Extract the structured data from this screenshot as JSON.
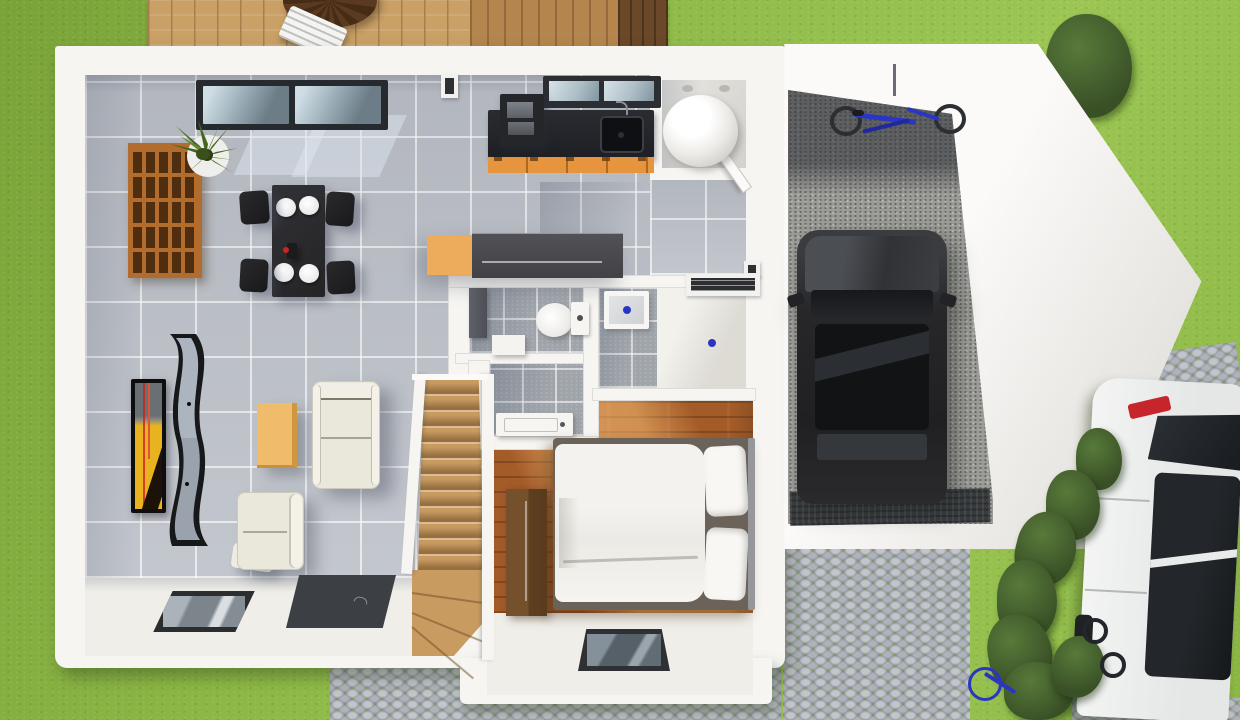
{
  "scene": {
    "title": "3D top-down floor plan rendering of a single-storey house with attached garage",
    "view": "top-down architectural visualization",
    "visible_text": ""
  },
  "palette": {
    "grass-a": "#8cb845",
    "grass-b": "#9cc654",
    "grass-c": "#7aa338",
    "deck-a": "#c9a066",
    "deck-line": "#a87f4c",
    "deck-dark": "#6b4827",
    "wall": "#f6f5f2",
    "tile": "#bcc0c8",
    "bath-tile": "#a0a5ab",
    "white-floor": "#efeee9",
    "wood": "#a35b28",
    "stair": "#c89b61",
    "counter": "#1f2126",
    "cabinet": "#e6953e",
    "island-orange": "#edac5c",
    "sofa": "#eae7db",
    "coffee": "#f0bc6b",
    "coffee-side": "#d1973f",
    "rug": "#3c3f43",
    "tv-yellow": "#e9b320",
    "tv-red": "#cc2121",
    "garage-b": "#9c9c97",
    "mat": "#393c3f",
    "cobble-stone": "#c2c5cb",
    "cobble-gap": "#7f9a48",
    "hedge-a": "#577a3a",
    "hedge-b": "#394f26",
    "bike": "#2a35c4",
    "car-red": "#c6252b"
  },
  "exterior": {
    "lawn": {
      "label": "lawn"
    },
    "deck": {
      "label": "wooden terrace",
      "objects": [
        "dark round slatted table",
        "white slatted chair"
      ]
    },
    "driveway": {
      "label": "cobblestone driveway with grass joints"
    },
    "hedge": {
      "label": "hedge row between driveway and street parking"
    },
    "shrub": {
      "label": "shrub at garage corner"
    },
    "white_car": {
      "label": "white car parked at right edge",
      "details": [
        "red tail light",
        "dark glass roof",
        "black wheels"
      ]
    },
    "bicycles": [
      {
        "label": "blue bicycle hung on garage wall"
      },
      {
        "label": "bicycle leaning at hedge"
      },
      {
        "label": "blue bicycle at lawn edge"
      }
    ]
  },
  "rooms": [
    {
      "id": "living-room",
      "label": "open living / dining room",
      "floor": "grey ceramic tile",
      "objects": [
        "sliding glass door",
        "cube storage shelf",
        "potted plant",
        "black dining table",
        "four black chairs",
        "four white plates",
        "wall TV with yellow artwork",
        "wave-shaped media console",
        "orange coffee table",
        "cream two-seat sofa",
        "cream armchair",
        "ottoman",
        "dark grey rug",
        "glass floor panel"
      ]
    },
    {
      "id": "kitchen",
      "label": "open kitchen",
      "objects": [
        "black worktop",
        "inset sink with faucet",
        "orange cabinet fronts",
        "tall appliance column",
        "window above sink",
        "island with orange sideboard"
      ]
    },
    {
      "id": "utility-room",
      "label": "technical room",
      "objects": [
        "water-heater cylinder",
        "ceiling spotlights"
      ]
    },
    {
      "id": "entry-hall",
      "label": "entrance hall",
      "objects": [
        "open door leaf",
        "wall radiator",
        "blue floor marker"
      ]
    },
    {
      "id": "wc",
      "label": "toilet room",
      "objects": [
        "toilet with cistern",
        "wall cupboard",
        "waste bin"
      ]
    },
    {
      "id": "washroom",
      "label": "shower room",
      "objects": [
        "washbasin counter",
        "shower tray with blue drain"
      ]
    },
    {
      "id": "bedroom",
      "label": "bedroom",
      "floor": "wood parquet",
      "objects": [
        "double bed with white duvet",
        "two pillows",
        "headboard",
        "wardrobe",
        "glass floor panel"
      ]
    },
    {
      "id": "staircase",
      "label": "wooden staircase with winder treads and white stringers"
    },
    {
      "id": "garage",
      "label": "garage",
      "floor": "concrete",
      "objects": [
        "black car",
        "blue bicycle on wall",
        "entrance mat"
      ]
    }
  ]
}
